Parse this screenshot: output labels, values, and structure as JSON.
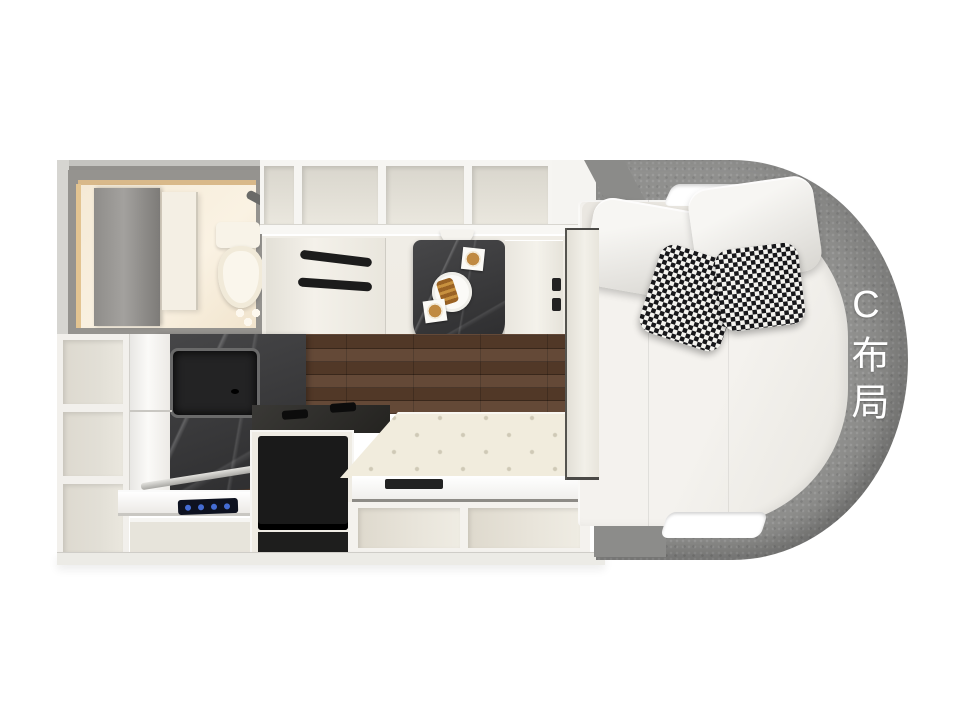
{
  "layout": {
    "label": "C布局"
  },
  "colors": {
    "background": "#ffffff",
    "wall_grey": "#d6d5d1",
    "wall_dark": "#95938f",
    "frame_white": "#f6f5f2",
    "cabinet_cream": "#efece4",
    "compartment_inner": "#e2dfd6",
    "bathroom_warm": "#f5ead6",
    "wood_brown": "#5a3e2b",
    "marble_dark": "#39393b",
    "appliance_black": "#1a1a1a",
    "bench_cream": "#f1ecdd",
    "bed_white": "#f4f2ee",
    "surround_grey": "#90908e",
    "houndstooth_dark": "#17171a",
    "cooktop_blue": "#4a77e8",
    "coffee_tan": "#c08a42",
    "label_white": "#ffffff"
  }
}
